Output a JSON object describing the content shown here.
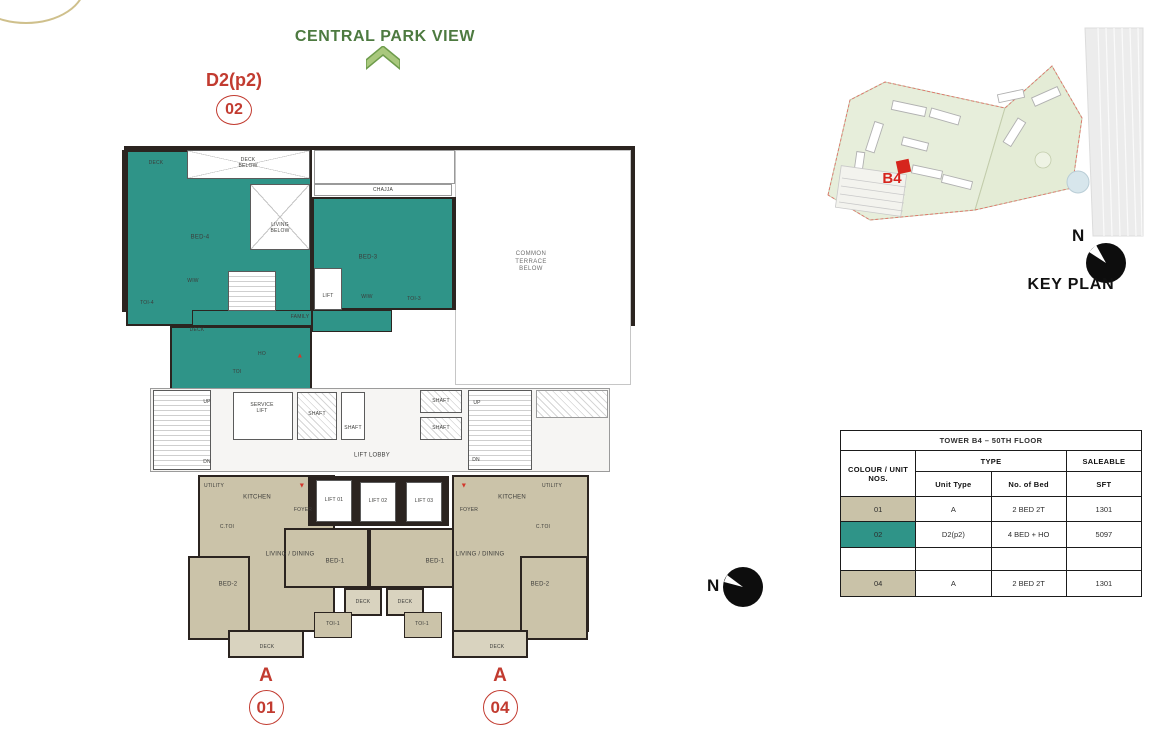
{
  "page": {
    "view_direction_label": "CENTRAL PARK VIEW",
    "highlight_unit": {
      "type_label": "D2(p2)",
      "unit_number": "02"
    }
  },
  "key_plan": {
    "title": "KEY PLAN",
    "tower_label": "B4",
    "north_label": "N"
  },
  "site_compass": {
    "north_label": "N"
  },
  "unit_table": {
    "title": "TOWER B4 – 50TH FLOOR",
    "headers": {
      "colour_unit": "COLOUR / UNIT\nNOS.",
      "type": "TYPE",
      "saleable": "SALEABLE",
      "unit_type": "Unit Type",
      "no_of_bed": "No. of Bed",
      "sft": "SFT"
    },
    "rows": [
      {
        "unit": "01",
        "unit_type": "A",
        "beds": "2 BED  2T",
        "sft": "1301",
        "color": "#c9c2a8"
      },
      {
        "unit": "02",
        "unit_type": "D2(p2)",
        "beds": "4 BED + HO",
        "sft": "5097",
        "color": "#2f9488"
      },
      {
        "unit": "",
        "unit_type": "",
        "beds": "",
        "sft": "",
        "color": "#ffffff"
      },
      {
        "unit": "04",
        "unit_type": "A",
        "beds": "2 BED  2T",
        "sft": "1301",
        "color": "#c9c2a8"
      }
    ]
  },
  "footer_units": [
    {
      "type_label": "A",
      "unit_number": "01"
    },
    {
      "type_label": "A",
      "unit_number": "04"
    }
  ],
  "colors": {
    "unit_02_teal": "#2f9488",
    "unit_beige": "#c9c2a8",
    "accent_red": "#c23b30",
    "title_green": "#4d7a40",
    "wall_dark": "#2b2420"
  },
  "plan": {
    "labels": [
      {
        "text": "DECK",
        "x": 156,
        "y": 163,
        "cls": "xs"
      },
      {
        "text": "DECK\nBELOW",
        "x": 248,
        "y": 163,
        "cls": "xs"
      },
      {
        "text": "BED-4",
        "x": 200,
        "y": 238
      },
      {
        "text": "LIVING\nBELOW",
        "x": 280,
        "y": 228,
        "cls": "xs"
      },
      {
        "text": "CHAJJA",
        "x": 383,
        "y": 190,
        "cls": "xs"
      },
      {
        "text": "BED-3",
        "x": 368,
        "y": 258
      },
      {
        "text": "WIW",
        "x": 193,
        "y": 281,
        "cls": "xs"
      },
      {
        "text": "TOI-4",
        "x": 147,
        "y": 303,
        "cls": "xs"
      },
      {
        "text": "DECK",
        "x": 197,
        "y": 330,
        "cls": "xs"
      },
      {
        "text": "FAMILY",
        "x": 300,
        "y": 317,
        "cls": "xs"
      },
      {
        "text": "WIW",
        "x": 367,
        "y": 297,
        "cls": "xs"
      },
      {
        "text": "TOI-3",
        "x": 414,
        "y": 299,
        "cls": "xs"
      },
      {
        "text": "HO",
        "x": 262,
        "y": 354,
        "cls": "xs"
      },
      {
        "text": "TOI",
        "x": 237,
        "y": 372,
        "cls": "xs"
      },
      {
        "text": "LIFT",
        "x": 328,
        "y": 296,
        "cls": "xs"
      },
      {
        "text": "COMMON\nTERRACE\nBELOW",
        "x": 531,
        "y": 262,
        "cls": "dim"
      },
      {
        "text": "UP",
        "x": 207,
        "y": 402,
        "cls": "xs"
      },
      {
        "text": "DN",
        "x": 207,
        "y": 462,
        "cls": "xs"
      },
      {
        "text": "SERVICE\nLIFT",
        "x": 262,
        "y": 408,
        "cls": "xs"
      },
      {
        "text": "SHAFT",
        "x": 317,
        "y": 414,
        "cls": "xs"
      },
      {
        "text": "SHAFT",
        "x": 353,
        "y": 428,
        "cls": "xs"
      },
      {
        "text": "LIFT LOBBY",
        "x": 372,
        "y": 456
      },
      {
        "text": "SHAFT",
        "x": 441,
        "y": 401,
        "cls": "xs"
      },
      {
        "text": "SHAFT",
        "x": 441,
        "y": 428,
        "cls": "xs"
      },
      {
        "text": "UP",
        "x": 477,
        "y": 403,
        "cls": "xs"
      },
      {
        "text": "DN",
        "x": 476,
        "y": 460,
        "cls": "xs"
      },
      {
        "text": "UTILITY",
        "x": 214,
        "y": 486,
        "cls": "xs"
      },
      {
        "text": "KITCHEN",
        "x": 257,
        "y": 498
      },
      {
        "text": "FOYER",
        "x": 303,
        "y": 510,
        "cls": "xs"
      },
      {
        "text": "C.TOI",
        "x": 227,
        "y": 527,
        "cls": "xs"
      },
      {
        "text": "LIVING / DINING",
        "x": 290,
        "y": 555
      },
      {
        "text": "BED-2",
        "x": 228,
        "y": 585
      },
      {
        "text": "DECK",
        "x": 267,
        "y": 647,
        "cls": "xs"
      },
      {
        "text": "LIFT 01",
        "x": 334,
        "y": 500,
        "cls": "xs"
      },
      {
        "text": "LIFT 02",
        "x": 378,
        "y": 501,
        "cls": "xs"
      },
      {
        "text": "LIFT 03",
        "x": 424,
        "y": 501,
        "cls": "xs"
      },
      {
        "text": "BED-1",
        "x": 335,
        "y": 562
      },
      {
        "text": "BED-1",
        "x": 435,
        "y": 562
      },
      {
        "text": "DECK",
        "x": 363,
        "y": 602,
        "cls": "xs"
      },
      {
        "text": "DECK",
        "x": 405,
        "y": 602,
        "cls": "xs"
      },
      {
        "text": "TOI-1",
        "x": 333,
        "y": 624,
        "cls": "xs"
      },
      {
        "text": "TOI-1",
        "x": 422,
        "y": 624,
        "cls": "xs"
      },
      {
        "text": "FOYER",
        "x": 469,
        "y": 510,
        "cls": "xs"
      },
      {
        "text": "KITCHEN",
        "x": 512,
        "y": 498
      },
      {
        "text": "UTILITY",
        "x": 552,
        "y": 486,
        "cls": "xs"
      },
      {
        "text": "C.TOI",
        "x": 543,
        "y": 527,
        "cls": "xs"
      },
      {
        "text": "LIVING / DINING",
        "x": 480,
        "y": 555
      },
      {
        "text": "BED-2",
        "x": 540,
        "y": 585
      },
      {
        "text": "DECK",
        "x": 497,
        "y": 647,
        "cls": "xs"
      },
      {
        "text": "▼",
        "x": 302,
        "y": 487,
        "cls": "marker"
      },
      {
        "text": "▼",
        "x": 464,
        "y": 487,
        "cls": "marker"
      },
      {
        "text": "▲",
        "x": 300,
        "y": 357,
        "cls": "marker"
      }
    ]
  }
}
